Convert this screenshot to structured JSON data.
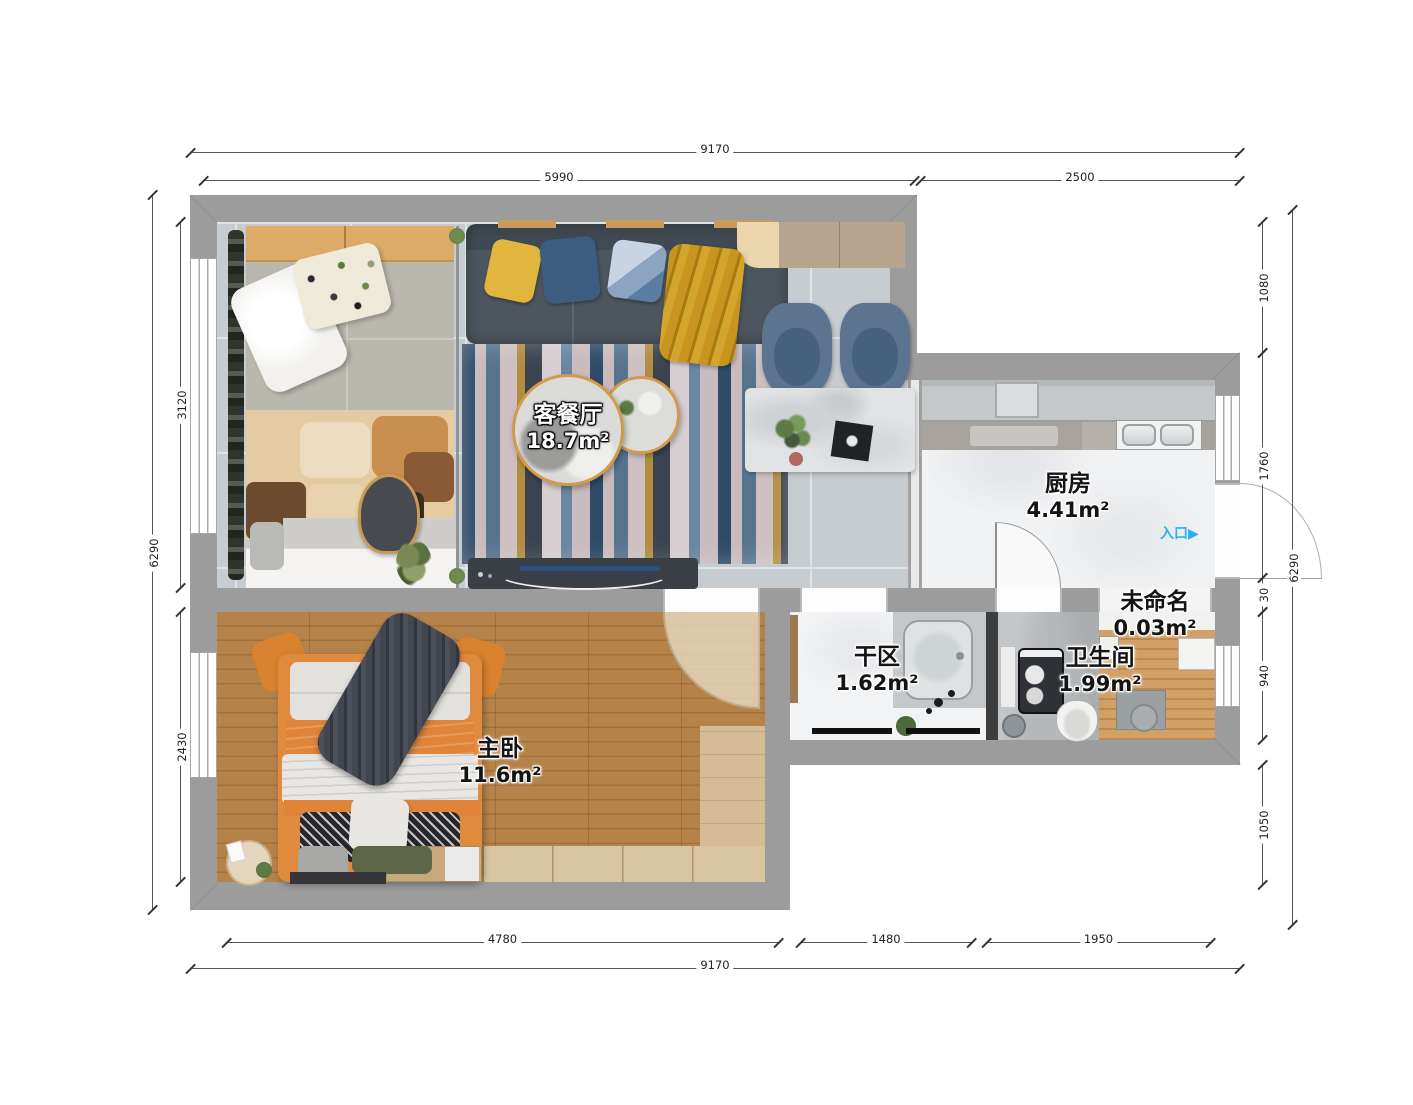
{
  "rooms": {
    "living": {
      "name": "客餐厅",
      "area": "18.7m²"
    },
    "kitchen": {
      "name": "厨房",
      "area": "4.41m²"
    },
    "dry_area": {
      "name": "干区",
      "area": "1.62m²"
    },
    "bathroom": {
      "name": "卫生间",
      "area": "1.99m²"
    },
    "unnamed": {
      "name": "未命名",
      "area": "0.03m²"
    },
    "master_bedroom": {
      "name": "主卧",
      "area": "11.6m²"
    }
  },
  "entrance": {
    "label": "入口",
    "arrow": "▶"
  },
  "dimensions": {
    "top": {
      "total": "9170",
      "left": "5990",
      "right": "2500"
    },
    "bottom": {
      "total": "9170",
      "left": "4780",
      "middle": "1480",
      "right": "1950"
    },
    "left": {
      "total": "6290",
      "top": "3120",
      "bottom": "2430"
    },
    "right": {
      "total": "6290",
      "s1": "1080",
      "s2": "1760",
      "s3": "30",
      "s4": "940",
      "s5": "1050"
    }
  },
  "colors": {
    "wall": "#9c9c9c",
    "entrance_blue": "#29b2ef",
    "living_floor": "#c7ccd0",
    "kitchen_floor": "#f1f2f4",
    "bath_floor": "#b6b9bc",
    "bedroom_floor": "#b5824a",
    "wood_slat_floor": "#d2a066"
  }
}
